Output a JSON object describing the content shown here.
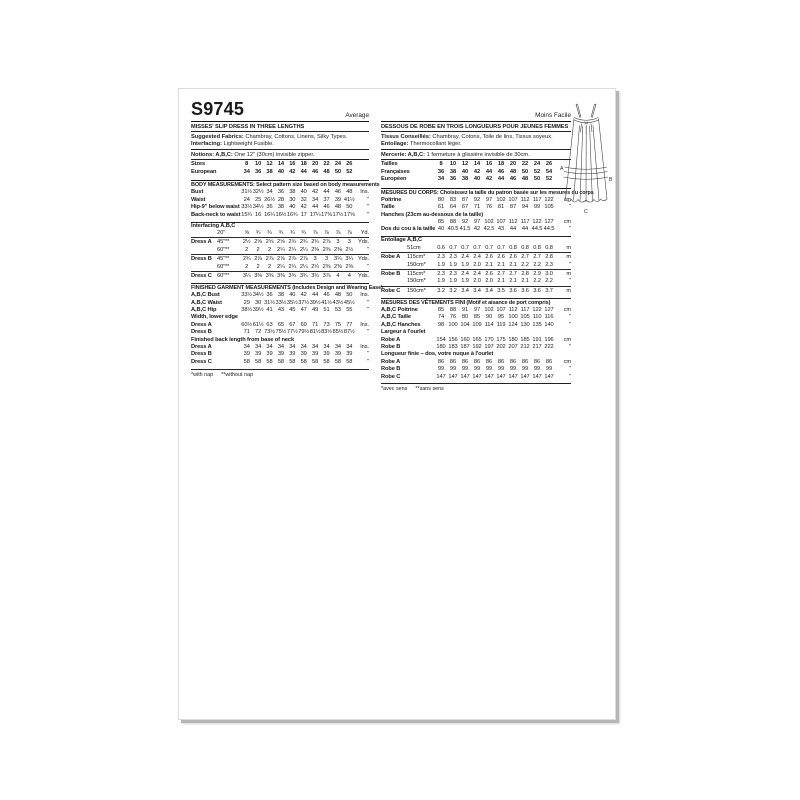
{
  "page": {
    "code": "S9745"
  },
  "english": {
    "difficulty": "Average",
    "title": "MISSES' SLIP DRESS IN THREE LENGTHS",
    "fabrics_label": "Suggested Fabrics:",
    "fabrics_text": " Chambray, Cottons, Linens, Silky Types. ",
    "interfacing_label": "Interfacing:",
    "interfacing_text": " Lightweight Fusible.",
    "notions_label": "Notions: A,B,C:",
    "notions_text": " One 12\" (30cm) invisible zipper.",
    "sizes": {
      "rows": [
        {
          "label": "Sizes",
          "values": [
            "8",
            "10",
            "12",
            "14",
            "16",
            "18",
            "20",
            "22",
            "24",
            "26"
          ],
          "unit": ""
        },
        {
          "label": "European",
          "values": [
            "34",
            "36",
            "38",
            "40",
            "42",
            "44",
            "46",
            "48",
            "50",
            "52"
          ],
          "unit": ""
        }
      ]
    },
    "body_header": "BODY MEASUREMENTS: Select pattern size based on body measurements",
    "body": {
      "rows": [
        {
          "label": "Bust",
          "values": [
            "31½",
            "32½",
            "34",
            "36",
            "38",
            "40",
            "42",
            "44",
            "46",
            "48"
          ],
          "unit": "Ins."
        },
        {
          "label": "Waist",
          "values": [
            "24",
            "25",
            "26½",
            "28",
            "30",
            "32",
            "34",
            "37",
            "39",
            "41½"
          ],
          "unit": "\""
        },
        {
          "label": "Hip-9\" below waist",
          "values": [
            "33½",
            "34½",
            "36",
            "38",
            "40",
            "42",
            "44",
            "46",
            "48",
            "50"
          ],
          "unit": "\""
        },
        {
          "label": "Back-neck to waist",
          "values": [
            "15¾",
            "16",
            "16¼",
            "16½",
            "16¾",
            "17",
            "17¼",
            "17⅜",
            "17½",
            "17⅝"
          ],
          "unit": "\""
        }
      ]
    },
    "interfacing_header": "Interfacing A,B,C",
    "yardage": {
      "rows": [
        {
          "label": "",
          "sub": "20\"",
          "values": [
            "⅝",
            "¾",
            "¾",
            "¾",
            "¾",
            "¾",
            "⅞",
            "⅞",
            "⅞",
            "⅞"
          ],
          "unit": "Yd."
        },
        {
          "label": "Dress A",
          "sub": "45\"**",
          "values": [
            "2½",
            "2⅝",
            "2⅝",
            "2⅝",
            "2¾",
            "2¾",
            "2¾",
            "2⅞",
            "3",
            "3"
          ],
          "unit": "Yds."
        },
        {
          "label": "",
          "sub": "60\"**",
          "values": [
            "2",
            "2",
            "2",
            "2¼",
            "2¼",
            "2¼",
            "2⅜",
            "2⅜",
            "2⅜",
            "2½"
          ],
          "unit": "\""
        },
        {
          "label": "Dress B",
          "sub": "45\"**",
          "values": [
            "2¾",
            "2⅞",
            "2⅞",
            "2⅞",
            "2⅞",
            "2⅞",
            "3",
            "3",
            "3¼",
            "3¼"
          ],
          "unit": "Yds."
        },
        {
          "label": "",
          "sub": "60\"**",
          "values": [
            "2",
            "2",
            "2",
            "2¼",
            "2¼",
            "2¼",
            "2¼",
            "2⅜",
            "2⅜",
            "2⅜"
          ],
          "unit": "\""
        },
        {
          "label": "Dress C",
          "sub": "60\"**",
          "values": [
            "3¼",
            "3⅜",
            "3⅜",
            "3⅜",
            "3¾",
            "3¾",
            "3¾",
            "3⅞",
            "4",
            "4"
          ],
          "unit": "Yds."
        }
      ]
    },
    "finished_header": "FINISHED GARMENT MEASUREMENTS (Includes Design and Wearing Ease)",
    "finished": {
      "rows": [
        {
          "label": "A,B,C Bust",
          "values": [
            "33½",
            "34½",
            "36",
            "38",
            "40",
            "42",
            "44",
            "46",
            "48",
            "50"
          ],
          "unit": "Ins."
        },
        {
          "label": "A,B,C Waist",
          "values": [
            "29",
            "30",
            "31½",
            "33½",
            "35½",
            "37½",
            "39½",
            "41½",
            "43½",
            "45½"
          ],
          "unit": "\""
        },
        {
          "label": "A,B,C Hip",
          "values": [
            "38½",
            "39½",
            "41",
            "43",
            "45",
            "47",
            "49",
            "51",
            "53",
            "55"
          ],
          "unit": "\""
        },
        {
          "type": "label",
          "label": "Width, lower edge"
        },
        {
          "label": "Dress A",
          "values": [
            "60½",
            "61½",
            "63",
            "65",
            "67",
            "69",
            "71",
            "73",
            "75",
            "77"
          ],
          "unit": "Ins."
        },
        {
          "label": "Dress B",
          "values": [
            "71",
            "72",
            "73½",
            "75½",
            "77½",
            "79½",
            "81½",
            "83½",
            "85½",
            "87½"
          ],
          "unit": "\""
        },
        {
          "type": "label",
          "label": "Finished back length from base of neck"
        },
        {
          "label": "Dress A",
          "values": [
            "34",
            "34",
            "34",
            "34",
            "34",
            "34",
            "34",
            "34",
            "34",
            "34"
          ],
          "unit": "Ins."
        },
        {
          "label": "Dress B",
          "values": [
            "39",
            "39",
            "39",
            "39",
            "39",
            "39",
            "39",
            "39",
            "39",
            "39"
          ],
          "unit": "\""
        },
        {
          "label": "Dress C",
          "values": [
            "58",
            "58",
            "58",
            "58",
            "58",
            "58",
            "58",
            "58",
            "58",
            "58"
          ],
          "unit": "\""
        }
      ]
    },
    "footnote": {
      "left": "*with nap",
      "right": "**without nap"
    }
  },
  "french": {
    "difficulty": "Moins Facile",
    "title": "DESSOUS DE ROBE EN TROIS LONGUEURS POUR JEUNES FEMMES",
    "fabrics_label": "Tissus Conseillés:",
    "fabrics_text": " Chambray, Cotons, Toile de lins, Tissus soyeux. ",
    "interfacing_label": "Entoilage:",
    "interfacing_text": " Thermocollant léger.",
    "notions_label": "Mercerie: A,B,C:",
    "notions_text": " 1 fermeture à glissière invisible de 30cm.",
    "sizes": {
      "rows": [
        {
          "label": "Tailles",
          "values": [
            "8",
            "10",
            "12",
            "14",
            "16",
            "18",
            "20",
            "22",
            "24",
            "26"
          ],
          "unit": ""
        },
        {
          "label": "Françaises",
          "values": [
            "36",
            "38",
            "40",
            "42",
            "44",
            "46",
            "48",
            "50",
            "52",
            "54"
          ],
          "unit": ""
        },
        {
          "label": "Européen",
          "values": [
            "34",
            "36",
            "38",
            "40",
            "42",
            "44",
            "46",
            "48",
            "50",
            "52"
          ],
          "unit": ""
        }
      ]
    },
    "body_header": "MESURES DU CORPS: Choisissez la taille du patron basée sur les mesures du corps",
    "body": {
      "rows": [
        {
          "label": "Poitrine",
          "values": [
            "80",
            "83",
            "87",
            "92",
            "97",
            "102",
            "107",
            "112",
            "117",
            "122"
          ],
          "unit": "cm"
        },
        {
          "label": "Taille",
          "values": [
            "61",
            "64",
            "67",
            "71",
            "76",
            "81",
            "87",
            "94",
            "99",
            "105"
          ],
          "unit": "\""
        },
        {
          "type": "label",
          "label": "Hanches (23cm au-dessous de la taille)"
        },
        {
          "label": "",
          "values": [
            "85",
            "88",
            "92",
            "97",
            "102",
            "107",
            "112",
            "117",
            "122",
            "127"
          ],
          "unit": "cm"
        },
        {
          "label": "Dos du cou à la taille",
          "values": [
            "40",
            "40.5",
            "41.5",
            "42",
            "42.5",
            "43",
            "44",
            "44",
            "44.5",
            "44.5"
          ],
          "unit": "\""
        }
      ]
    },
    "interfacing_header": "Entoilage A,B,C",
    "yardage": {
      "rows": [
        {
          "label": "",
          "sub": "51cm",
          "values": [
            "0.6",
            "0.7",
            "0.7",
            "0.7",
            "0.7",
            "0.7",
            "0.8",
            "0.8",
            "0.8",
            "0.8"
          ],
          "unit": "m"
        },
        {
          "label": "Robe A",
          "sub": "115cm*",
          "values": [
            "2.3",
            "2.3",
            "2.4",
            "2.4",
            "2.6",
            "2.6",
            "2.6",
            "2.7",
            "2.7",
            "2.8"
          ],
          "unit": "m"
        },
        {
          "label": "",
          "sub": "150cm*",
          "values": [
            "1.9",
            "1.9",
            "1.9",
            "2.0",
            "2.1",
            "2.1",
            "2.1",
            "2.2",
            "2.2",
            "2.3"
          ],
          "unit": "\""
        },
        {
          "label": "Robe B",
          "sub": "115cm*",
          "values": [
            "2.3",
            "2.3",
            "2.4",
            "2.4",
            "2.6",
            "2.7",
            "2.7",
            "2.8",
            "2.9",
            "3.0"
          ],
          "unit": "m"
        },
        {
          "label": "",
          "sub": "150cm*",
          "values": [
            "1.9",
            "1.9",
            "1.9",
            "2.0",
            "2.0",
            "2.1",
            "2.1",
            "2.1",
            "2.2",
            "2.2"
          ],
          "unit": "\""
        },
        {
          "label": "Robe C",
          "sub": "150cm*",
          "values": [
            "3.2",
            "3.2",
            "3.4",
            "3.4",
            "3.4",
            "3.5",
            "3.6",
            "3.6",
            "3.6",
            "3.7"
          ],
          "unit": "m"
        }
      ]
    },
    "finished_header": "MESURES DES VÊTEMENTS FINI (Motif et aisance de port compris)",
    "finished": {
      "rows": [
        {
          "label": "A,B,C Poitrine",
          "values": [
            "85",
            "88",
            "91",
            "97",
            "102",
            "107",
            "112",
            "117",
            "122",
            "127"
          ],
          "unit": "cm"
        },
        {
          "label": "A,B,C Taille",
          "values": [
            "74",
            "76",
            "80",
            "85",
            "90",
            "95",
            "100",
            "105",
            "110",
            "116"
          ],
          "unit": "\""
        },
        {
          "label": "A,B,C Hanches",
          "values": [
            "98",
            "100",
            "104",
            "109",
            "114",
            "119",
            "124",
            "130",
            "135",
            "140"
          ],
          "unit": "\""
        },
        {
          "type": "label",
          "label": "Largeur à l'ourlet"
        },
        {
          "label": "Robe A",
          "values": [
            "154",
            "156",
            "160",
            "165",
            "170",
            "175",
            "180",
            "185",
            "191",
            "196"
          ],
          "unit": "cm"
        },
        {
          "label": "Robe B",
          "values": [
            "180",
            "183",
            "187",
            "192",
            "197",
            "202",
            "207",
            "212",
            "217",
            "222"
          ],
          "unit": "\""
        },
        {
          "type": "label",
          "label": "Longueur finie – dos, votre nuque à l'ourlet"
        },
        {
          "label": "Robe A",
          "values": [
            "86",
            "86",
            "86",
            "86",
            "86",
            "86",
            "86",
            "86",
            "86",
            "86"
          ],
          "unit": "cm"
        },
        {
          "label": "Robe B",
          "values": [
            "99",
            "99",
            "99",
            "99",
            "99",
            "99",
            "99",
            "99",
            "99",
            "99"
          ],
          "unit": "\""
        },
        {
          "label": "Robe C",
          "values": [
            "147",
            "147",
            "147",
            "147",
            "147",
            "147",
            "147",
            "147",
            "147",
            "147"
          ],
          "unit": "\""
        }
      ]
    },
    "footnote": {
      "left": "*avec sens",
      "right": "**sans sens"
    }
  },
  "figure": {
    "letters": {
      "a": "A",
      "b": "B",
      "c": "C"
    }
  }
}
